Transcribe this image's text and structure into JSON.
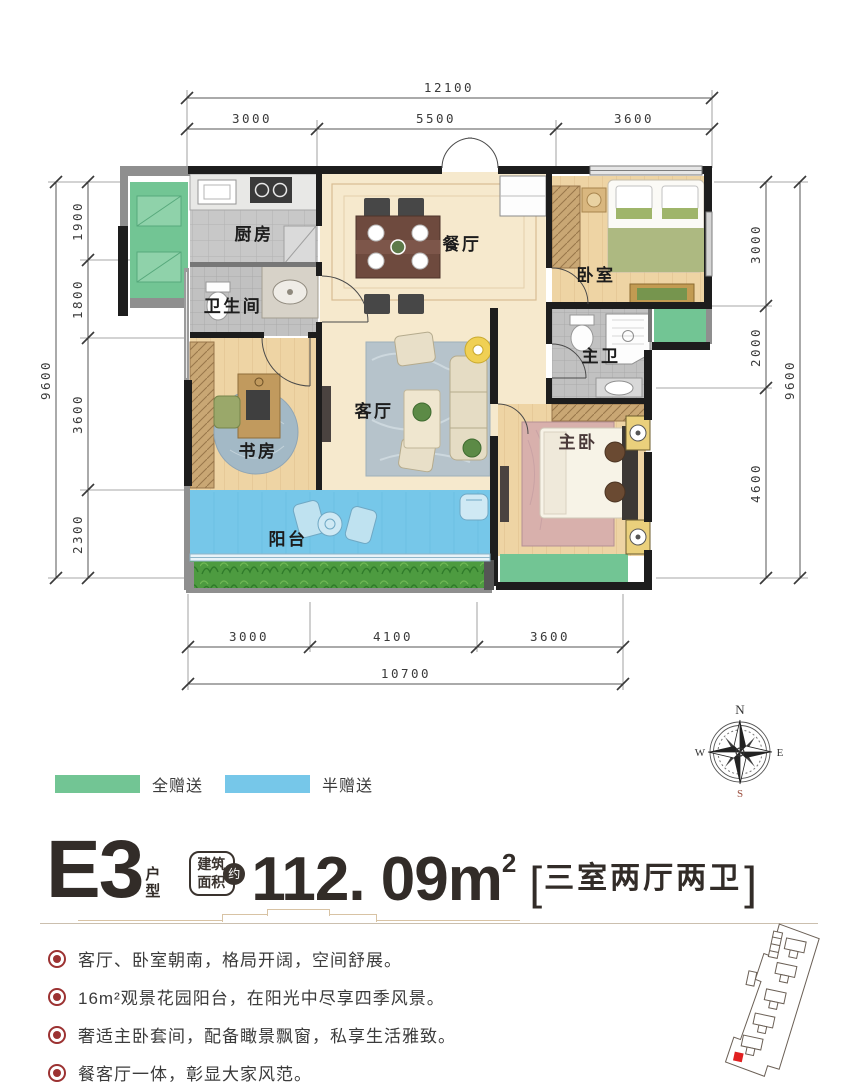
{
  "dimensions": {
    "top": {
      "total": "12100",
      "segments": [
        "3000",
        "5500",
        "3600"
      ]
    },
    "left": {
      "total": "9600",
      "segments": [
        "1900",
        "1800",
        "3600",
        "2300"
      ]
    },
    "right": {
      "total": "9600",
      "segments": [
        "3000",
        "2000",
        "4600"
      ]
    },
    "bottom": {
      "total": "10700",
      "segments": [
        "3000",
        "4100",
        "3600"
      ]
    }
  },
  "rooms": {
    "kitchen": "厨房",
    "bath": "卫生间",
    "dining": "餐厅",
    "bedroom": "卧室",
    "master_bath": "主卫",
    "living": "客厅",
    "study": "书房",
    "master_bedroom": "主卧",
    "balcony": "阳台"
  },
  "compass": {
    "n": "N",
    "e": "E",
    "s": "S",
    "w": "W"
  },
  "legend": [
    {
      "label": "全赠送",
      "color": "#72c594"
    },
    {
      "label": "半赠送",
      "color": "#76c7e9"
    }
  ],
  "title": {
    "code": "E3",
    "code_suffix": "户型",
    "area_label_line1": "建筑",
    "area_label_line2": "面积",
    "approx": "约",
    "area_value": "112. 09",
    "area_unit": "m",
    "area_sup": "2",
    "bracket_open": "[",
    "layout": "三室两厅两卫",
    "bracket_close": "]"
  },
  "features": [
    "客厅、卧室朝南，格局开阔，空间舒展。",
    "16m²观景花园阳台，在阳光中尽享四季风景。",
    "奢适主卧套间，配备瞰景飘窗，私享生活雅致。",
    "餐客厅一体，彰显大家风范。"
  ],
  "colors": {
    "gift_full": "#72c594",
    "gift_half": "#76c7e9",
    "bullet": "#9c3232"
  }
}
